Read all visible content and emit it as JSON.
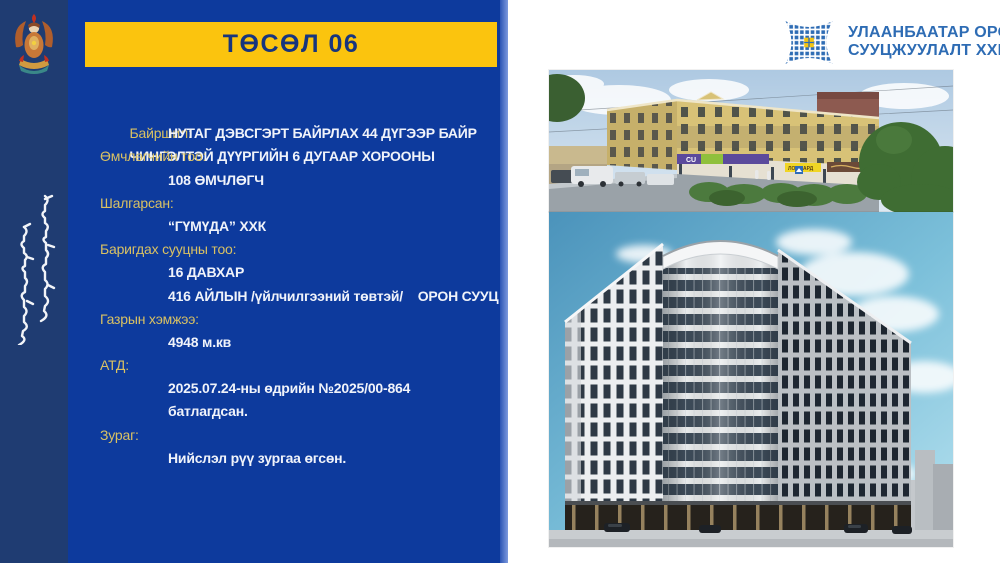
{
  "header": {
    "title": "ТӨСӨЛ 06"
  },
  "org_logo": {
    "line1": "УЛААНБААТАР ОРОН",
    "line2": "СУУЦЖУУЛАЛТ ХХК"
  },
  "slide": {
    "fields": [
      {
        "label": "Байршил:",
        "values": [
          "ЧИНГЭЛТЭЙ ДҮҮРГИЙН 6 ДУГААР ХОРООНЫ",
          "НУТАГ ДЭВСГЭРТ БАЙРЛАХ 44 ДҮГЭЭР БАЙР"
        ]
      },
      {
        "label": "Өмчлөгчийн тоо:",
        "values": [
          "108 ӨМЧЛӨГЧ"
        ]
      },
      {
        "label": "Шалгарсан:",
        "values": [
          "“ГҮМҮДА” ХХК"
        ]
      },
      {
        "label": "Баригдах сууцны тоо:",
        "values": [
          "16 ДАВХАР",
          "416 АЙЛЫН /үйлчилгээний төвтэй/    ОРОН СУУЦ"
        ]
      },
      {
        "label": "Газрын хэмжээ:",
        "values": [
          "4948 м.кв"
        ]
      },
      {
        "label": "АТД:",
        "values": [
          "2025.07.24-ны өдрийн №2025/00-864",
          "батлагдсан."
        ]
      },
      {
        "label": "Зураг:",
        "values": [
          "Нийслэл рүү зургаа өгсөн."
        ]
      }
    ]
  },
  "photos": {
    "street_signs": {
      "cu": "CU",
      "lombard": "ЛОМБАРД"
    }
  },
  "icons": {
    "city_emblem": "ulaanbaatar-city-emblem",
    "vertical_script": "traditional-mongolian-script",
    "logo_mark": "mosaic-x-star"
  },
  "colors": {
    "panel_blue": "#0d3a9d",
    "strip_navy": "#1f3c72",
    "accent_yellow": "#fbc40e",
    "label_gold": "#d9c163",
    "logo_blue": "#2e6cb4",
    "title_text": "#17357e"
  }
}
